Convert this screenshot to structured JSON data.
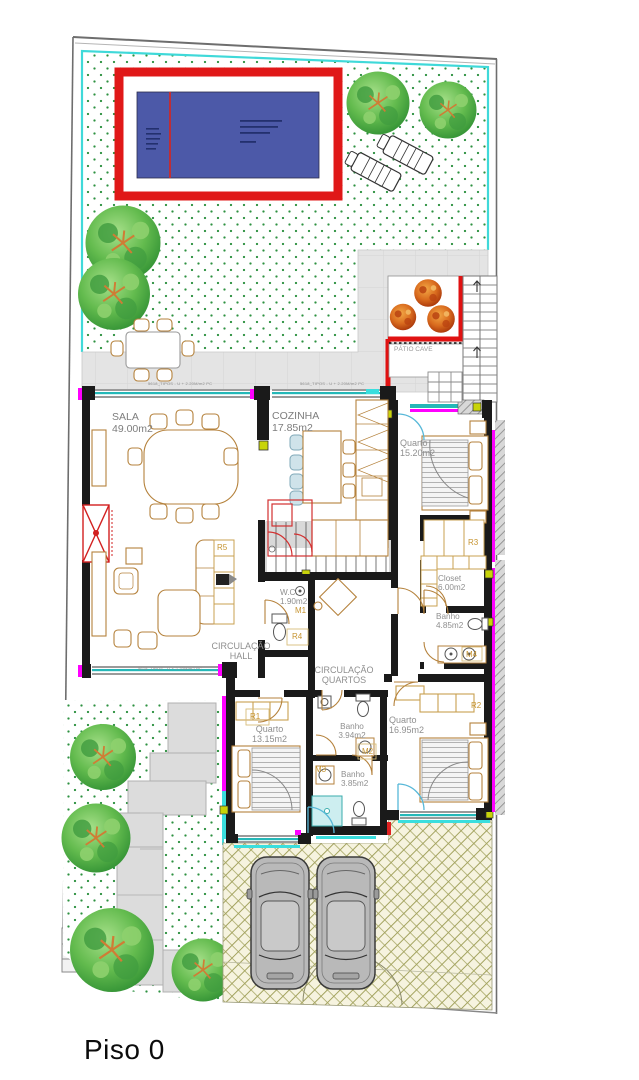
{
  "plan_title": "Piso 0",
  "rooms": {
    "sala": {
      "name": "SALA",
      "area": "49.00m2"
    },
    "cozinha": {
      "name": "COZINHA",
      "area": "17.85m2"
    },
    "quarto_suite": {
      "name": "Quarto",
      "area": "15.20m2"
    },
    "closet": {
      "name": "Closet",
      "area": "6.00m2"
    },
    "banho_suite": {
      "name": "Banho",
      "area": "4.85m2"
    },
    "wc": {
      "name": "W.C.",
      "area": "1.90m2"
    },
    "quarto2": {
      "name": "Quarto",
      "area": "13.15m2"
    },
    "banho2": {
      "name": "Banho",
      "area": "3.94m2"
    },
    "banho3": {
      "name": "Banho",
      "area": "3.85m2"
    },
    "quarto3": {
      "name": "Quarto",
      "area": "16.95m2"
    },
    "patio_cave": {
      "name": "PÁTIO CAVE"
    }
  },
  "circulation": {
    "hall": {
      "line1": "CIRCULAÇÃO",
      "line2": "HALL"
    },
    "quartos": {
      "line1": "CIRCULAÇÃO",
      "line2": "QUARTOS"
    }
  },
  "tags": {
    "r1": "R1",
    "r2": "R2",
    "r3": "R3",
    "r4": "R4",
    "r5": "R5",
    "m1": "M1",
    "m2": "M2",
    "m3": "M3",
    "m4": "M4"
  },
  "annotations": {
    "window_spec": "5618_TIPOS - U + 2.20M/m2 PC"
  },
  "colors": {
    "wall": "#1a1a1a",
    "highlight_magenta": "#ff00ff",
    "window_teal": "#25b8b8",
    "accent_cyan": "#3adede",
    "junction_yellow": "#c8d40a",
    "pool_water": "#4c59a8",
    "pool_border": "#e01818",
    "furniture": "#b5823c",
    "grass_dot": "#2d9140",
    "terrace_gray": "#e4e4e4",
    "herringbone": "#a3a35f",
    "tree_green": "#63bb4e",
    "tree_autumn": "#d2691e",
    "car_body": "#b9b9b9",
    "label_gray": "#8f8f8f",
    "tag_orange": "#c69430",
    "fireplace_red": "#d22020"
  }
}
